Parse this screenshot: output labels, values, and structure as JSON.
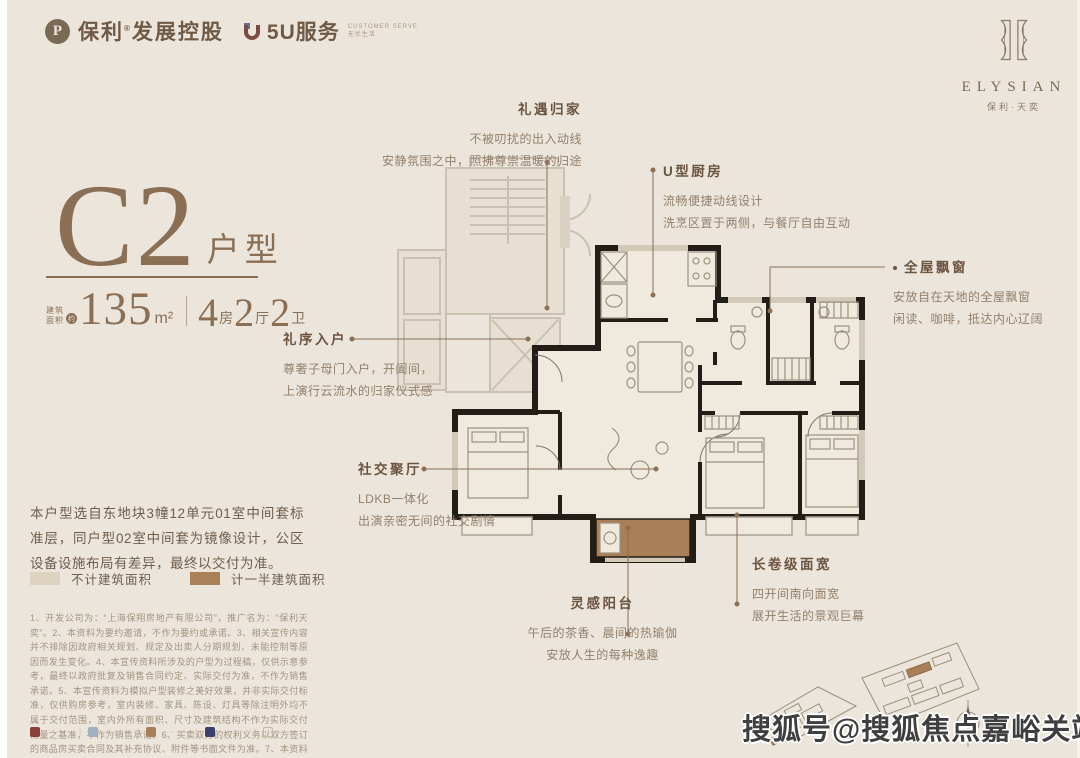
{
  "brand": {
    "poly_initial": "P",
    "poly_name": "保利",
    "poly_reg": "®",
    "poly_suffix": "发展控股",
    "service_name": "5U服务",
    "service_sub1": "CUSTOMER SERVE",
    "service_sub2": "无忧生活",
    "elysian": "ELYSIAN",
    "elysian_cn": "保利·天奕"
  },
  "unit": {
    "name": "C2",
    "name_suffix": "户型",
    "area_label_line1": "建筑",
    "area_label_line2": "面积",
    "area_approx": "约",
    "area_value": "135",
    "area_unit": "m²",
    "rooms": [
      {
        "num": "4",
        "label": "房"
      },
      {
        "num": "2",
        "label": "厅"
      },
      {
        "num": "2",
        "label": "卫"
      }
    ]
  },
  "description": "本户型选自东地块3幢12单元01室中间套标准层，同户型02室中间套为镜像设计，公区设备设施布局有差异，最终以交付为准。",
  "legend": [
    {
      "label": "不计建筑面积",
      "color": "#ddd3c0"
    },
    {
      "label": "计一半建筑面积",
      "color": "#aa8059"
    }
  ],
  "annotations": [
    {
      "title": "礼遇归家",
      "lines": [
        "不被叨扰的出入动线",
        "安静氛围之中，照拂尊崇温暖的归途"
      ]
    },
    {
      "title": "U型厨房",
      "lines": [
        "流畅便捷动线设计",
        "洗烹区置于两侧，与餐厅自由互动"
      ]
    },
    {
      "title": "全屋飘窗",
      "lines": [
        "安放自在天地的全屋飘窗",
        "闲读、咖啡，抵达内心辽阔"
      ]
    },
    {
      "title": "礼序入户",
      "lines": [
        "尊奢子母门入户，开阖间，",
        "上演行云流水的归家仪式感"
      ]
    },
    {
      "title": "社交聚厅",
      "lines": [
        "LDKB一体化",
        "出演亲密无间的社交剧情"
      ]
    },
    {
      "title": "灵感阳台",
      "lines": [
        "午后的茶香、晨间的热瑜伽",
        "安放人生的每种逸趣"
      ]
    },
    {
      "title": "长卷级面宽",
      "lines": [
        "四开间南向面宽",
        "展开生活的景观巨幕"
      ]
    }
  ],
  "disclaimer": "1、开发公司为：“上海保翔房地产有限公司”，推广名为：“保利天奕”。2、本资料为要约邀请，不作为要约或承诺。3、相关宣传内容并不排除因政府相关规划、规定及出卖人分期规划、未能控制等原因而发生变化。4、本宣传资料所涉及的户型为过程稿，仅供示意参考，最终以政府批复及销售合同约定、实际交付为准，不作为销售承诺。5、本宣传资料为模拟户型装修之美好效果，并非实际交付标准，仅供购房参考，室内装修、家具、陈设、灯具等除注明外均不属于交付范围，室内外所有面积、尺寸及建筑结构不作为实际交付衡量之基准，不作为销售承诺。6、买卖双方的权利义务以双方签订的商品房买卖合同及其补充协议、附件等书面文件为准。7、本资料所发布的内容为2025年6月11日前的信息，敬请留意最新资料。",
  "footer": {
    "separator": "|",
    "badges": [
      {
        "label": "··· ·· ·· ··",
        "color": "#8a4038"
      },
      {
        "label": "··· ·· ·· ··",
        "color": "#9fb0c2"
      },
      {
        "label": "··· ·· ·· ··",
        "color": "#aa7f57"
      },
      {
        "label": "··· ·· ·· ··",
        "color": "#39406b"
      },
      {
        "label": "··· ·· ··",
        "color": "#c5b9a4"
      }
    ]
  },
  "watermark": "搜狐号@搜狐焦点嘉峪关站",
  "colors": {
    "background": "#ece5db",
    "accent_brown": "#8a6f55",
    "wall_black": "#221d17",
    "half_area_brown": "#aa8059",
    "excluded_area_light": "#ddd3c0",
    "faded_common": "#c9c1b2"
  }
}
